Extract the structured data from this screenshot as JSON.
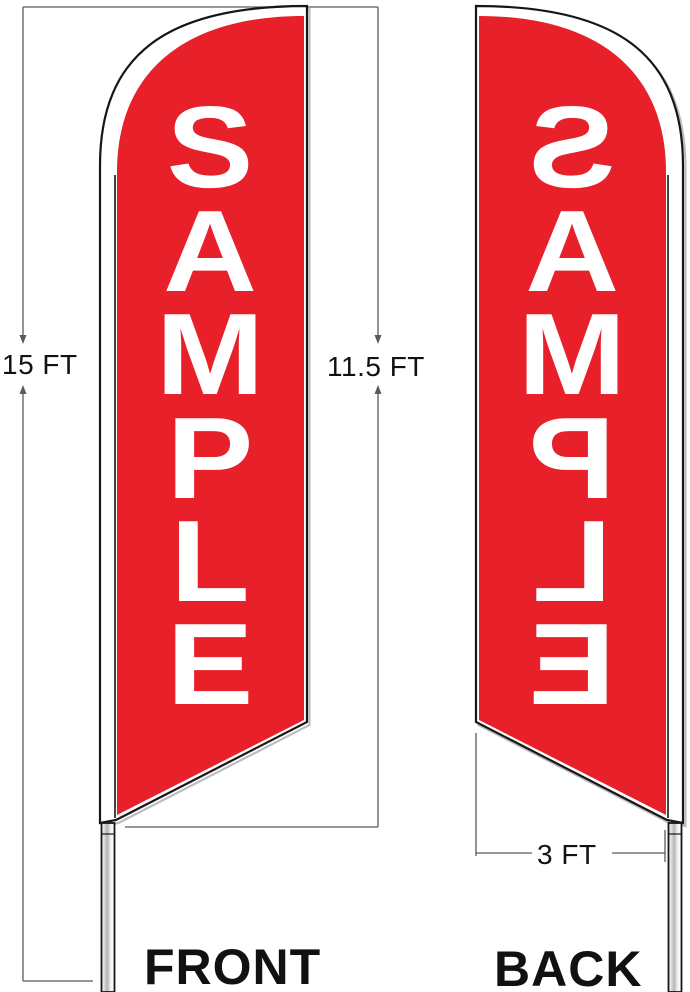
{
  "title": "Feather flag front and back dimension diagram",
  "colors": {
    "flag_red": "#e8202a",
    "outline": "#161616",
    "dim_line": "#5a5a5a",
    "label": "#111111",
    "shadow": "#bdbdbd",
    "pole_shade": "#b5b5b5"
  },
  "front_flag": {
    "label": "FRONT",
    "letters": [
      "S",
      "A",
      "M",
      "P",
      "L",
      "E"
    ]
  },
  "back_flag": {
    "label": "BACK",
    "letters": [
      "S",
      "A",
      "M",
      "P",
      "L",
      "E"
    ]
  },
  "dimensions": {
    "pole_height": "15 FT",
    "flag_height": "11.5 FT",
    "flag_width": "3 FT"
  }
}
